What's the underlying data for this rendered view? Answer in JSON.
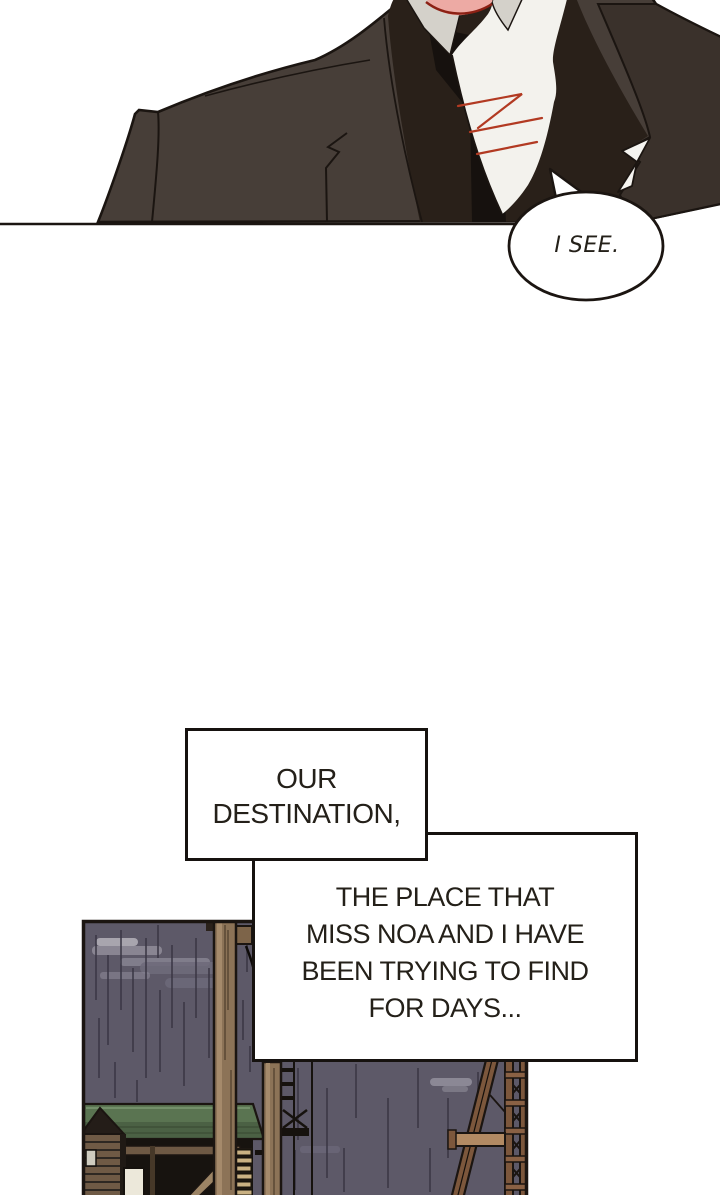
{
  "speech_bubble": {
    "text": "I SEE."
  },
  "narration_box_1": {
    "lines": [
      "OUR",
      "DESTINATION,"
    ]
  },
  "narration_box_2": {
    "lines": [
      "THE PLACE THAT",
      "MISS NOA AND I HAVE",
      "BEEN TRYING TO FIND",
      "FOR DAYS..."
    ]
  },
  "colors": {
    "ink": "#1b1511",
    "text_ink": "#242019",
    "panel_border": "#16120f",
    "suit": "#473e38",
    "suit_shadow": "#292019",
    "suit_lapel": "#3a312b",
    "tie": "#16110e",
    "shirt": "#f3f2ed",
    "collar": "#d4d1ca",
    "skin": "#edaaa4",
    "skin_outline": "#8c2014",
    "cravat_accent": "#b23a22",
    "sky": "#5d5968",
    "cloud_light": "#908d9a",
    "cloud_mid": "#6e6a7a",
    "rain": "#3a3745",
    "roof_green": "#5a7451",
    "roof_green_dark": "#4b6144",
    "pole": "#8c7357",
    "pole_highlight": "#a58a6b",
    "building_dark": "#17130f",
    "slat_brown": "#6f5a45",
    "window_lit": "#ece8da",
    "lumber": "#c9b183",
    "tower_rust": "#7c573c",
    "tower_light": "#8a6144",
    "tower_beam": "#b28a63"
  }
}
